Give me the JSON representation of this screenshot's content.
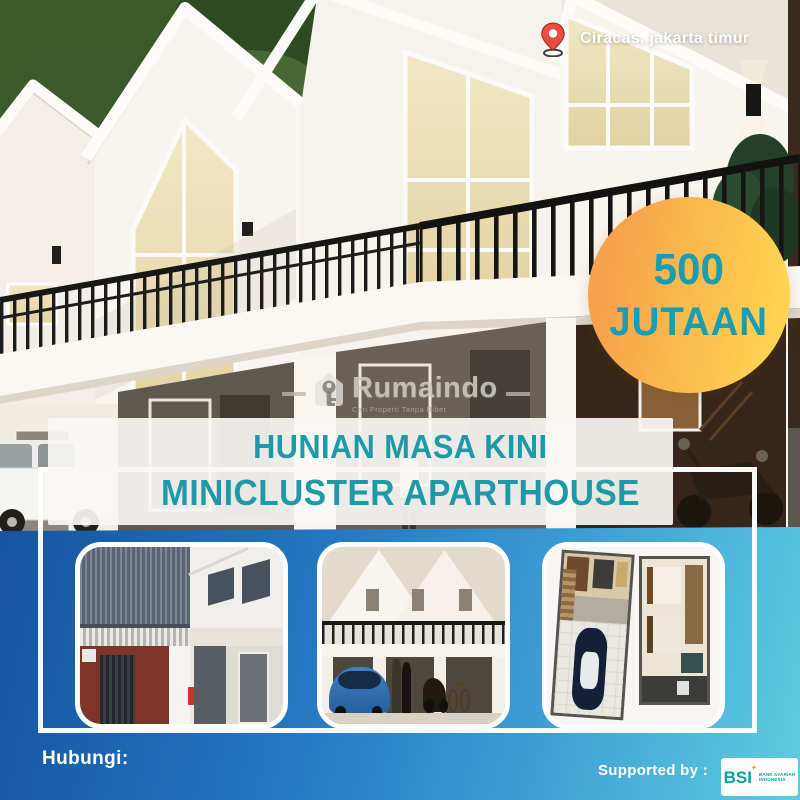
{
  "location": {
    "icon": "map-pin-icon",
    "text": "Ciracas, jakarta timur"
  },
  "price_badge": {
    "line1": "500",
    "line2": "JUTAAN"
  },
  "watermark": {
    "brand": "Rumaindo",
    "tagline": "Cari Properti Tanpa Ribet",
    "icon": "house-key-icon"
  },
  "title": {
    "line1": "HUNIAN MASA KINI",
    "line2": "MINICLUSTER APARTHOUSE"
  },
  "gallery": {
    "photos": [
      {
        "alt": "construction progress photo of two-storey unit"
      },
      {
        "alt": "finished mini cluster townhouse exterior with car and motorbike"
      },
      {
        "alt": "3D floor plan top view with carport and bedrooms"
      }
    ]
  },
  "footer": {
    "contact_label": "Hubungi:",
    "supported_label": "Supported by :",
    "bsi": {
      "abbr": "BSI",
      "line1": "BANK SYARIAH",
      "line2": "INDONESIA"
    }
  },
  "colors": {
    "accent-teal": "#1d99a8",
    "badge-text": "#189db3",
    "badge-orange": "#f6a14b",
    "badge-yellow": "#ffd24f",
    "footer-blue-dark": "#15549f",
    "footer-blue-light": "#5ecddf",
    "pin-red": "#ea4d3f",
    "bsi-green": "#00a39a"
  }
}
